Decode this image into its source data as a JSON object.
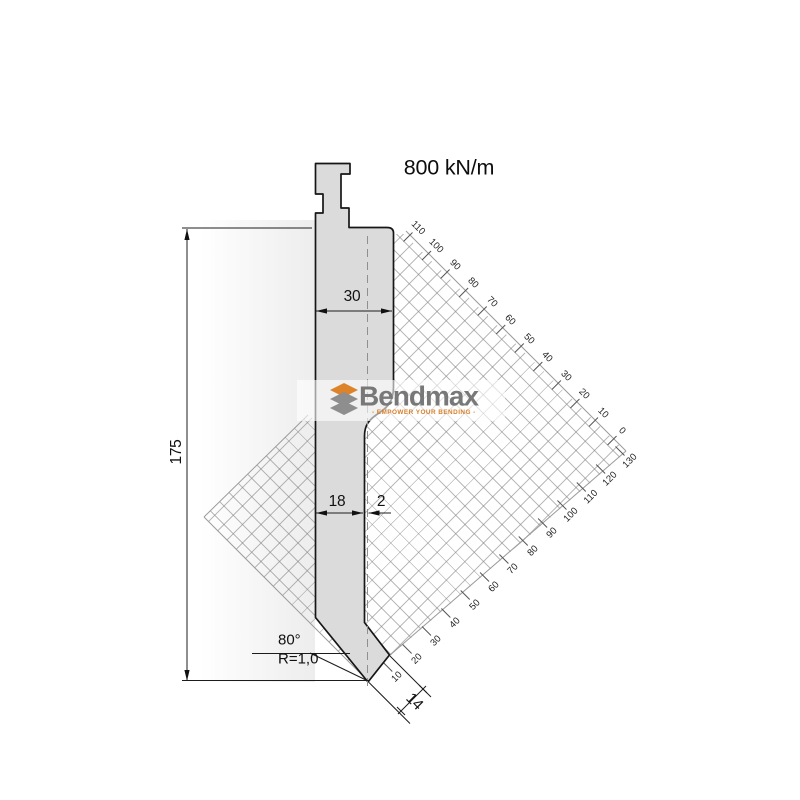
{
  "drawing": {
    "capacity_label": "800 kN/m",
    "dims": {
      "total_height": "175",
      "head_width": "30",
      "shaft_width": "18",
      "tip_offset": "2",
      "tip_angle": "80°",
      "tip_radius": "R=1,0",
      "tip_face_width": "14"
    }
  },
  "logo": {
    "name": "Bendmax",
    "tagline": "- EMPOWER YOUR BENDING -"
  },
  "axes": {
    "upper": [
      "110",
      "100",
      "90",
      "80",
      "70",
      "60",
      "50",
      "40",
      "30",
      "20",
      "10",
      "0"
    ],
    "lower": [
      "130",
      "120",
      "110",
      "100",
      "90",
      "80",
      "70",
      "60",
      "50",
      "40",
      "30",
      "20",
      "10"
    ]
  },
  "colors": {
    "accent_orange": "#DD8329",
    "logo_gray": "#787878",
    "blade_fill": "#DBDBDB",
    "outline": "#161616",
    "grid_line": "#A9A9A9"
  }
}
